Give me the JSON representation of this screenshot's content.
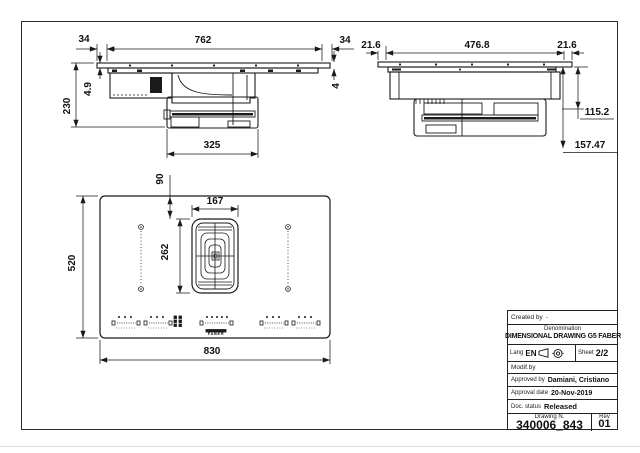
{
  "views": {
    "front": {
      "overhang_left": "34",
      "width": "762",
      "overhang_right": "34",
      "plate_thickness": "4.9",
      "height": "230",
      "glass_thickness": "4",
      "duct_width": "325"
    },
    "side": {
      "overhang_left": "21.6",
      "depth": "476.8",
      "overhang_right": "21.6",
      "body_height": "115.2",
      "total_height": "157.47"
    },
    "plan": {
      "width": "830",
      "depth": "520",
      "grille_width": "167",
      "grille_length": "262",
      "grille_offset_top": "90",
      "brand_logo": "FABER"
    }
  },
  "title_block": {
    "created_by_label": "Created by",
    "created_by_value": "-",
    "denomination_label": "Denomination",
    "denomination_value": "DIMENSIONAL DRAWING G5 FABER",
    "lang_label": "Lang",
    "lang_value": "EN",
    "sheet_label": "Sheet",
    "sheet_value": "2/2",
    "modif_by_label": "Modif.by",
    "approved_by_label": "Approved by",
    "approved_by_value": "Damiani, Cristiano",
    "approval_date_label": "Approval date",
    "approval_date_value": "20-Nov-2019",
    "doc_status_label": "Doc. status",
    "doc_status_value": "Released",
    "drawing_number_label": "Drawing N.",
    "drawing_number_value": "340006_843",
    "rev_label": "Rev",
    "rev_value": "01",
    "icons": {
      "projection": "first-angle-projection-icon",
      "target": "crosshair-icon"
    },
    "line_color": "#222222"
  }
}
